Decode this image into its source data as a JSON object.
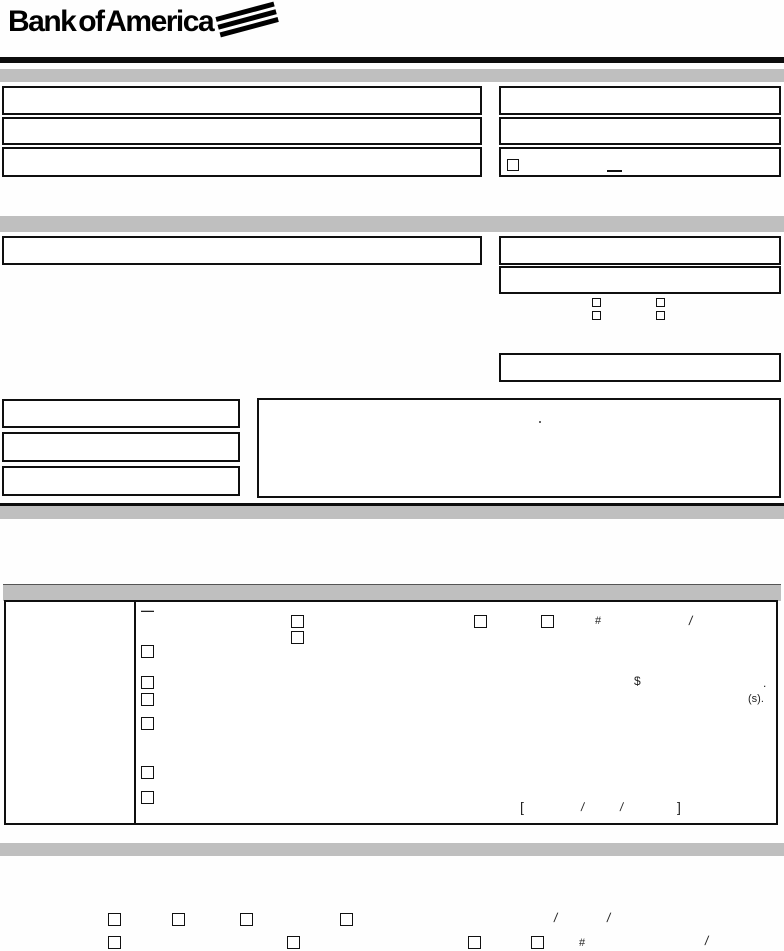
{
  "brand": {
    "logo_text": "Bank of America"
  },
  "colors": {
    "bar_gray": "#bfbfbf",
    "rule_black": "#0d0d0d",
    "page_bg": "#fefefe",
    "ink": "#1a1a1a"
  },
  "glyphs": {
    "dash": "—",
    "hash": "#",
    "slash": "/",
    "dollar": "$",
    "period": ".",
    "s_suffix": "(s).",
    "bracket_open": "[",
    "bracket_close": "]"
  }
}
